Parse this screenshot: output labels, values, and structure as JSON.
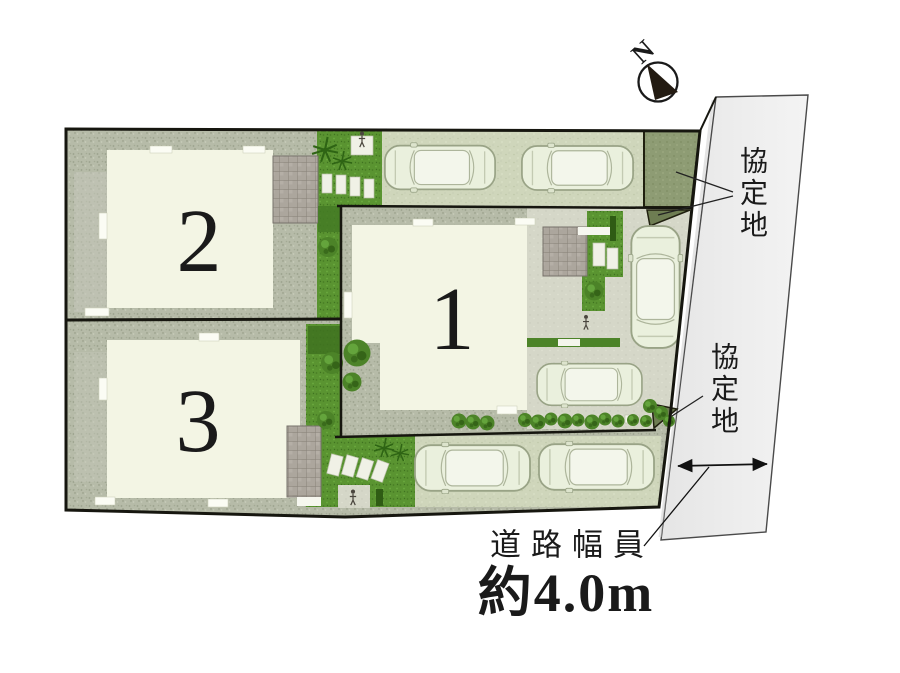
{
  "site_plan": {
    "compass": {
      "north_label": "N"
    },
    "lots": [
      {
        "number": "1"
      },
      {
        "number": "2"
      },
      {
        "number": "3"
      }
    ],
    "annotations": {
      "agreement_area_top": "協定地",
      "agreement_area_middle": "協定地",
      "road_width_title": "道路幅員",
      "road_width_value": "約4.0m"
    },
    "icons": {
      "compass": "compass-needle-icon",
      "pedestrian": "figure-icon",
      "vehicle": "car-icon",
      "planting": "shrub-icon"
    },
    "colors": {
      "background": "#ffffff",
      "outline": "#1b1b12",
      "gravel": "#b6bba8",
      "lawn": "#5a9431",
      "house": "#f3f5e4",
      "parking_pad": "#cfd6bb",
      "driveway": "#d5d7c8",
      "terrace_tile": "#aca69d",
      "agreement_parcel": "#8e9c74",
      "road": "#ededed",
      "car_body": "#eaf0dd",
      "text": "#1a1a1a"
    }
  }
}
